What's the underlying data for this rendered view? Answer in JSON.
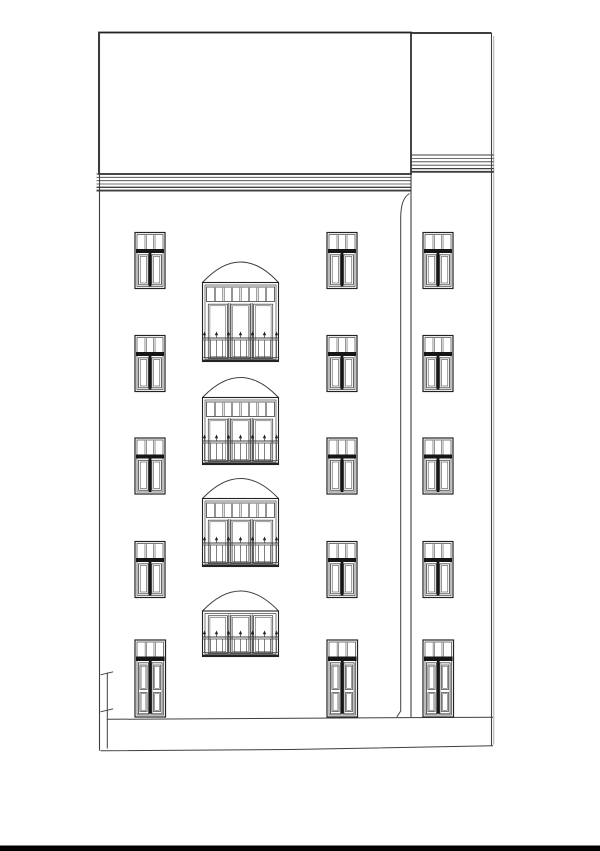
{
  "title": "Street elevation line drawing of a five-storey residential building with a recessed right wing, arched balcony doors and picket railings",
  "palette": {
    "bg": "#ffffff",
    "ink": "#3f3f3f",
    "ink_strong": "#222222",
    "ink_dark": "#161616",
    "ink_faint": "#9a9a9a",
    "paper_edge": "#000000"
  },
  "canvas": {
    "w": 600,
    "h": 851
  },
  "paper_edge_strip": {
    "x": 0,
    "y": 845.5,
    "w": 600,
    "h": 5.5
  },
  "shell": {
    "roof_block": {
      "x": 99,
      "y": 32.5,
      "w": 312,
      "h": 141.5
    },
    "wing_top_y": 33,
    "wing_left_x": 411,
    "wing_right_x": 491.5,
    "wing_right_x2": 493.8,
    "left_wall_x": 99.5,
    "left_wall_y2": 750.6,
    "mid_wall_y2": 717.3,
    "right_wall_y2": 745.8,
    "main_cornice": {
      "x1": 96.5,
      "x2": 411,
      "lines": [
        [
          174,
          1.0
        ],
        [
          177.3,
          0.8
        ],
        [
          180.7,
          0.8
        ],
        [
          184,
          0.8
        ],
        [
          187.3,
          1.3
        ],
        [
          190.6,
          1.9
        ]
      ]
    },
    "wing_cornice": {
      "x1": 411,
      "x2": 493.8,
      "lines": [
        [
          155,
          1.0
        ],
        [
          158.4,
          0.8
        ],
        [
          161.8,
          0.8
        ],
        [
          165.2,
          0.8
        ],
        [
          168.6,
          1.3
        ],
        [
          171.8,
          1.9
        ]
      ]
    },
    "base_line": {
      "x1": 106.8,
      "y1": 719.3,
      "x2": 493,
      "y2": 717.2
    },
    "street_line": [
      [
        100.5,
        750.8
      ],
      [
        290,
        749.5
      ],
      [
        493,
        745.8
      ]
    ],
    "drainpipe": {
      "top_x": 409.5,
      "top_y": 193.5,
      "pipe_x": 400.7,
      "bend_y": 218,
      "bottom_y": 711,
      "foot_x": 396.8,
      "foot_y": 717
    },
    "boundary_marker": {
      "x": 107.3,
      "y1": 672.5,
      "y2": 748.5,
      "ticks": [
        [
          100.5,
          674.8,
          113.2,
          671.8
        ],
        [
          100.5,
          711.8,
          113.2,
          708.8
        ]
      ]
    }
  },
  "standard_windows": {
    "cols_x": [
      135,
      327,
      423
    ],
    "rows_y": [
      232.5,
      335.5,
      438,
      541.5
    ],
    "w": 30,
    "h": 56,
    "transom_panes": 3
  },
  "ground_doors": {
    "cols_x": [
      135,
      327,
      423
    ],
    "y": 640,
    "w": 30.5,
    "h": 77,
    "transom_panes": 3
  },
  "balconies": {
    "x": 202.5,
    "w": 76,
    "transom_h": 14.5,
    "transom_panes": 8,
    "door_panels": 3,
    "items": [
      {
        "peak_y": 262,
        "top": 282.5,
        "bottom": 361.5,
        "transom": true
      },
      {
        "peak_y": 377.5,
        "top": 397.5,
        "bottom": 464.5,
        "transom": true
      },
      {
        "peak_y": 478.5,
        "top": 498.5,
        "bottom": 566.5,
        "transom": true
      },
      {
        "peak_y": 591,
        "top": 611,
        "bottom": 656.5,
        "transom": false
      }
    ]
  }
}
